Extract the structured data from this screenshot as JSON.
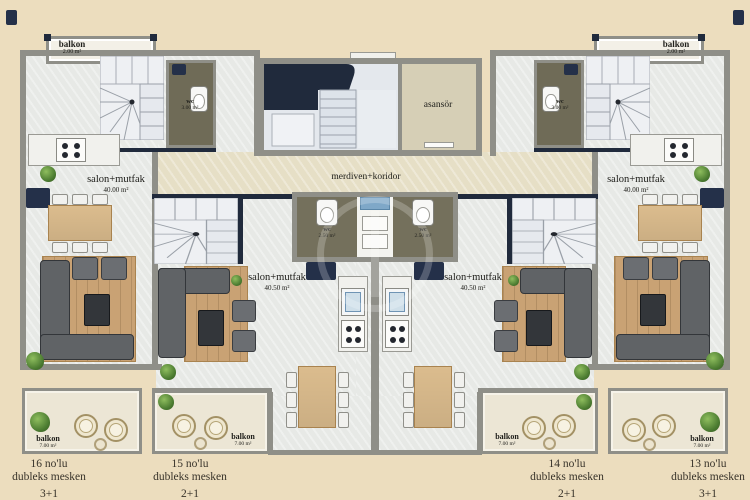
{
  "common": {
    "elevator_label": "asansör",
    "corridor_label": "merdiven+koridor"
  },
  "top_balconies": {
    "left": {
      "label": "balkon",
      "area": "2.00 m²"
    },
    "right": {
      "label": "balkon",
      "area": "2.00 m²"
    }
  },
  "wc": {
    "left": {
      "label": "wc",
      "area": "3.00 m²"
    },
    "right": {
      "label": "wc",
      "area": "3.00 m²"
    },
    "center_left": {
      "label": "wc",
      "area": "2.50 m²"
    },
    "center_right": {
      "label": "wc",
      "area": "2.50 m²"
    }
  },
  "units": [
    {
      "no": "16 no'lu",
      "type_label": "dubleks mesken",
      "rooms": "3+1",
      "net": "Net :50.00 m²",
      "salon": "salon+mutfak",
      "salon_area": "40.00 m²",
      "balkon": "balkon",
      "balkon_area": "7.00 m²"
    },
    {
      "no": "15 no'lu",
      "type_label": "dubleks mesken",
      "rooms": "2+1",
      "net": "Net :50.00 m²",
      "salon": "salon+mutfak",
      "salon_area": "40.50 m²",
      "balkon": "balkon",
      "balkon_area": "7.00 m²"
    },
    {
      "no": "14 no'lu",
      "type_label": "dubleks mesken",
      "rooms": "2+1",
      "net": "Net :50.00 m²",
      "salon": "salon+mutfak",
      "salon_area": "40.50 m²",
      "balkon": "balkon",
      "balkon_area": "7.00 m²"
    },
    {
      "no": "13 no'lu",
      "type_label": "dubleks mesken",
      "rooms": "3+1",
      "net": "Net :50.00 m²",
      "salon": "salon+mutfak",
      "salon_area": "40.00 m²",
      "balkon": "balkon",
      "balkon_area": "7.00 m²"
    }
  ],
  "colors": {
    "background": "#ecddbe",
    "wall": "#8f8f88",
    "accent_navy": "#202a3c",
    "floor": "#e7e9e6",
    "corridor": "#e6dfc6",
    "wood": "#e2c292"
  }
}
